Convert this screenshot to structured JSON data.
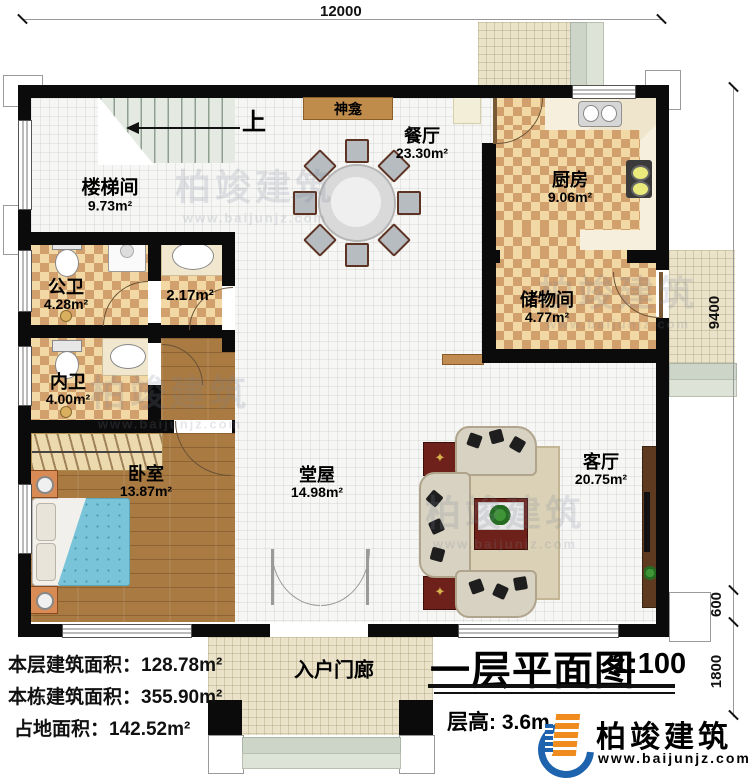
{
  "dimensions": {
    "width_top": "12000",
    "height_main": "9400",
    "height_step": "600",
    "height_porch": "1800"
  },
  "rooms": {
    "stairwell": {
      "name": "楼梯间",
      "area": "9.73m²"
    },
    "dining": {
      "name": "餐厅",
      "area": "23.30m²"
    },
    "kitchen": {
      "name": "厨房",
      "area": "9.06m²"
    },
    "storage": {
      "name": "储物间",
      "area": "4.77m²"
    },
    "public_bath": {
      "name": "公卫",
      "area": "4.28m²"
    },
    "washroom": {
      "area": "2.17m²"
    },
    "private_bath": {
      "name": "内卫",
      "area": "4.00m²"
    },
    "bedroom": {
      "name": "卧室",
      "area": "13.87m²"
    },
    "main_hall": {
      "name": "堂屋",
      "area": "14.98m²"
    },
    "living_room": {
      "name": "客厅",
      "area": "20.75m²"
    },
    "porch": {
      "name": "入户门廊"
    },
    "shrine": {
      "name": "神龛"
    }
  },
  "stairs": {
    "up_label": "上"
  },
  "stats": [
    {
      "label": "本层建筑面积：",
      "value": "128.78m²"
    },
    {
      "label": "本栋建筑面积：",
      "value": "355.90m²"
    },
    {
      "label": "占地面积：",
      "value": "142.52m²"
    }
  ],
  "title_block": {
    "title": "一层平面图",
    "scale": "1:100",
    "floor_height": "层高: 3.6m"
  },
  "brand": {
    "name": "柏竣建筑",
    "url": "www.baijunjz.com"
  },
  "watermark": {
    "name": "柏竣建筑",
    "url": "www.baijunjz.com"
  }
}
